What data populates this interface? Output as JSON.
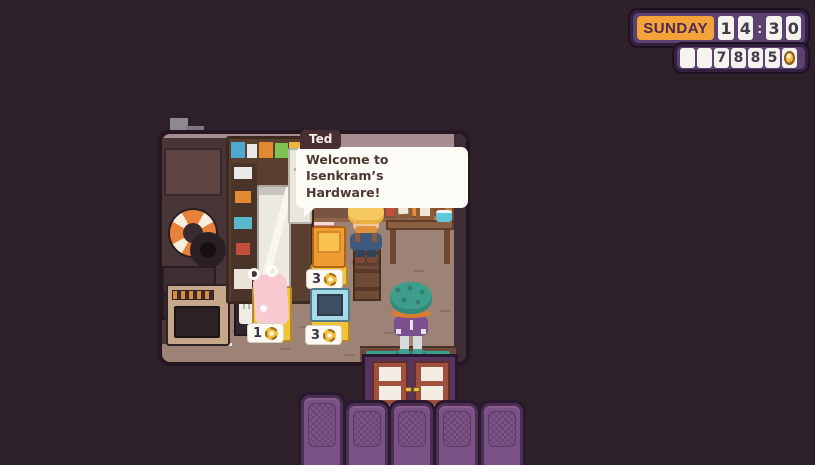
{
  "hud": {
    "day_label": "SUNDAY",
    "time": {
      "digits": [
        "1",
        "4",
        "3",
        "0"
      ],
      "separator": ":",
      "display": "14:30"
    },
    "money": {
      "digits": [
        "",
        "",
        "7",
        "8",
        "8",
        "5"
      ],
      "amount_display": "7885",
      "currency_icon": "coin"
    }
  },
  "dialog": {
    "speaker_name": "Ted",
    "line1": "Welcome to Isenkram’s",
    "line2": "Hardware!"
  },
  "shop": {
    "items": [
      {
        "name": "orange-vending-machine",
        "price": "3",
        "currency_icon": "gear-coin"
      },
      {
        "name": "pink-inflatable",
        "price": "1",
        "currency_icon": "gear-coin"
      },
      {
        "name": "blue-tv",
        "price": "3",
        "currency_icon": "gear-coin"
      }
    ]
  },
  "inventory": {
    "slot_count": 5,
    "selected_slot": 1
  },
  "colors": {
    "background": "#2e2029",
    "hud_panel": "#5d4170",
    "day_badge": "#f4a33b",
    "digit_box": "#f5f3ed",
    "coin_gold": "#f3bd3d",
    "floor": "#9d8375",
    "door_red": "#a0503e",
    "mat_teal": "#3ba08c",
    "slot_purple": "#7a5285"
  }
}
